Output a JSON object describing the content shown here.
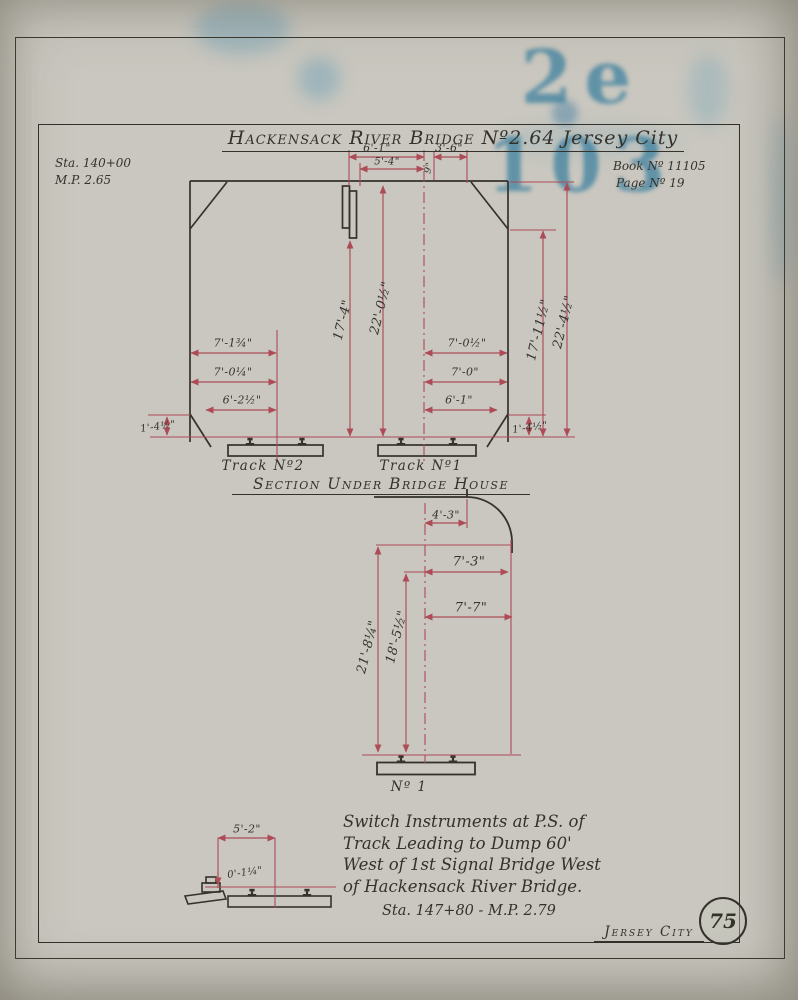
{
  "colors": {
    "paper": "#c9c7bf",
    "ink": "#35322c",
    "dimension_red": "#ad4b57",
    "stamp_blue": "#1c7098"
  },
  "stamp": {
    "text": "2e 103"
  },
  "drawing": {
    "title_main": "Hackensack River Bridge Nº2.64",
    "title_suffix": "Jersey City",
    "station_note": {
      "line1": "Sta. 140+00",
      "line2": "M.P. 2.65"
    },
    "book_note": {
      "line1": "Book Nº 11105",
      "line2": "Page Nº 19"
    }
  },
  "upper_section": {
    "caption": "Section Under Bridge House",
    "track2_label": "Track Nº2",
    "track1_label": "Track Nº1",
    "dim_6_1_top": "6'-1\"",
    "dim_5_4": "5'-4\"",
    "dim_3_6": "3'-6\"",
    "dim_9": "9\"",
    "dim_17_4": "17'-4\"",
    "dim_22_0_half": "22'-0½\"",
    "dim_17_11_half": "17'-11½\"",
    "dim_22_4_half": "22'-4½\"",
    "dim_7_1_three_quarter": "7'-1¾\"",
    "dim_7_0_quarter": "7'-0¼\"",
    "dim_6_2_half": "6'-2½\"",
    "dim_1_4_half_left": "1'-4½\"",
    "dim_7_0_half": "7'-0½\"",
    "dim_7_0": "7'-0\"",
    "dim_6_1_right": "6'-1\"",
    "dim_1_4_half_right": "1'-4½\""
  },
  "lower_section": {
    "track_label": "Nº 1",
    "dim_4_3": "4'-3\"",
    "dim_7_3": "7'-3\"",
    "dim_7_7": "7'-7\"",
    "dim_21_8_quarter": "21'-8¼\"",
    "dim_18_5_half": "18'-5½\""
  },
  "inset": {
    "dim_5_2": "5'-2\"",
    "dim_0_1_quarter": "0'-1¼\""
  },
  "note": {
    "lines": [
      "Switch Instruments at P.S. of",
      "Track Leading to Dump 60'",
      "West of 1st Signal Bridge West",
      "of Hackensack River Bridge."
    ],
    "station": "Sta. 147+80 - M.P. 2.79"
  },
  "footer": {
    "location": "Jersey City",
    "sheet_number": "75"
  }
}
